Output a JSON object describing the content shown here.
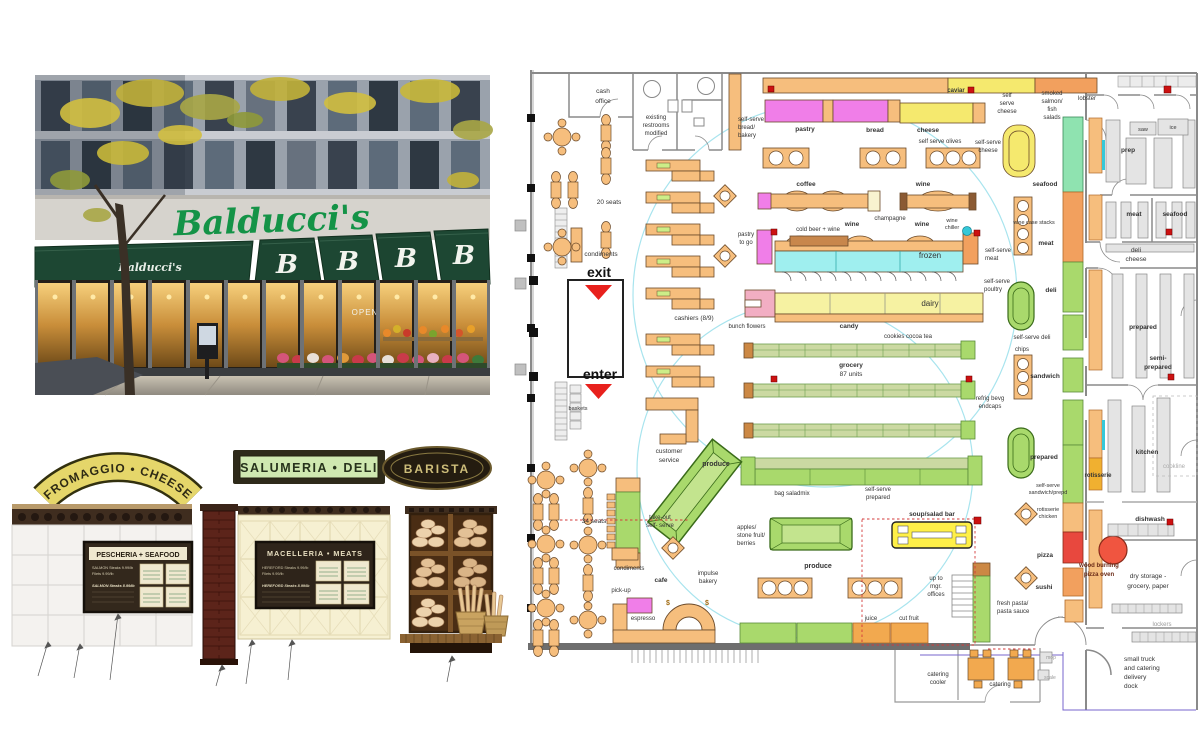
{
  "photo": {
    "script_sign": "Balducci's",
    "awning_script": "Balducci's",
    "awning_monogram": "B",
    "open_sign": "OPEN"
  },
  "signs": {
    "fromaggio": "FROMAGGIO • CHEESE",
    "salumeria": "SALUMERIA • DELI",
    "barista": "BARISTA"
  },
  "elevations": {
    "pescheria_title": "PESCHERIA + SEAFOOD",
    "pescheria_lines": [
      "SALMON Steaks   9.99/lb",
      "Filets   9.99/lb",
      "SALMON  Steaks   8.99/lb"
    ],
    "macelleria_title": "MACELLERIA • MEATS",
    "macelleria_lines": [
      "HEREFORD Steaks   9.99/lb",
      "Filets   9.99/lb",
      "HEREFORD  Steaks   8.99/lb"
    ]
  },
  "plan": {
    "labels": [
      {
        "t": "cash",
        "x": 603,
        "y": 93,
        "s": 6.5
      },
      {
        "t": "office",
        "x": 603,
        "y": 103,
        "s": 6.5
      },
      {
        "t": "existing",
        "x": 656,
        "y": 119,
        "s": 6
      },
      {
        "t": "restrooms",
        "x": 656,
        "y": 127,
        "s": 6
      },
      {
        "t": "modified",
        "x": 656,
        "y": 135,
        "s": 6
      },
      {
        "t": "20 seats",
        "x": 609,
        "y": 204,
        "s": 6.5
      },
      {
        "t": "condiments",
        "x": 601,
        "y": 256,
        "s": 6.5
      },
      {
        "t": "exit",
        "x": 599,
        "y": 277,
        "s": 14,
        "b": 1,
        "c": "#111"
      },
      {
        "t": "enter",
        "x": 600,
        "y": 379,
        "s": 14,
        "b": 1,
        "c": "#111"
      },
      {
        "t": "baskets",
        "x": 578,
        "y": 410,
        "s": 5.5
      },
      {
        "t": "cashiers (8/9)",
        "x": 694,
        "y": 320,
        "s": 6.5
      },
      {
        "t": "customer",
        "x": 669,
        "y": 453,
        "s": 6.5
      },
      {
        "t": "service",
        "x": 669,
        "y": 462,
        "s": 6.5
      },
      {
        "t": "self-serve",
        "x": 738,
        "y": 121,
        "s": 6,
        "a": "s"
      },
      {
        "t": "bread/",
        "x": 738,
        "y": 129,
        "s": 6,
        "a": "s"
      },
      {
        "t": "bakery",
        "x": 738,
        "y": 137,
        "s": 6,
        "a": "s"
      },
      {
        "t": "pastry",
        "x": 805,
        "y": 131,
        "s": 6.5,
        "b": 1
      },
      {
        "t": "bread",
        "x": 875,
        "y": 132,
        "s": 6.5,
        "b": 1
      },
      {
        "t": "cheese",
        "x": 928,
        "y": 132,
        "s": 6.5,
        "b": 1
      },
      {
        "t": "self serve olives",
        "x": 940,
        "y": 143,
        "s": 6
      },
      {
        "t": "caviar",
        "x": 956,
        "y": 92,
        "s": 6,
        "b": 1
      },
      {
        "t": "self",
        "x": 1007,
        "y": 97,
        "s": 6
      },
      {
        "t": "serve",
        "x": 1007,
        "y": 105,
        "s": 6
      },
      {
        "t": "cheese",
        "x": 1007,
        "y": 113,
        "s": 6
      },
      {
        "t": "smoked",
        "x": 1052,
        "y": 95,
        "s": 6
      },
      {
        "t": "salmon/",
        "x": 1052,
        "y": 103,
        "s": 6
      },
      {
        "t": "fish",
        "x": 1052,
        "y": 111,
        "s": 6
      },
      {
        "t": "salads",
        "x": 1052,
        "y": 119,
        "s": 6
      },
      {
        "t": "lobster",
        "x": 1087,
        "y": 100,
        "s": 6
      },
      {
        "t": "self-serve",
        "x": 988,
        "y": 144,
        "s": 6
      },
      {
        "t": "cheese",
        "x": 988,
        "y": 152,
        "s": 6
      },
      {
        "t": "coffee",
        "x": 806,
        "y": 186,
        "s": 6.5,
        "b": 1
      },
      {
        "t": "wine",
        "x": 923,
        "y": 186,
        "s": 6.5,
        "b": 1
      },
      {
        "t": "champagne",
        "x": 890,
        "y": 220,
        "s": 6
      },
      {
        "t": "wine",
        "x": 852,
        "y": 226,
        "s": 6.5,
        "b": 1
      },
      {
        "t": "wine",
        "x": 922,
        "y": 226,
        "s": 6.5,
        "b": 1
      },
      {
        "t": "wine",
        "x": 952,
        "y": 222,
        "s": 5.5
      },
      {
        "t": "chiller",
        "x": 952,
        "y": 229,
        "s": 5.5
      },
      {
        "t": "cold beer + wine",
        "x": 818,
        "y": 231,
        "s": 6
      },
      {
        "t": "pastry",
        "x": 746,
        "y": 236,
        "s": 6
      },
      {
        "t": "to go",
        "x": 746,
        "y": 244,
        "s": 6
      },
      {
        "t": "frozen",
        "x": 930,
        "y": 258,
        "s": 8
      },
      {
        "t": "self-serve",
        "x": 985,
        "y": 252,
        "s": 6,
        "a": "s"
      },
      {
        "t": "meat",
        "x": 985,
        "y": 260,
        "s": 6,
        "a": "s"
      },
      {
        "t": "self-serve",
        "x": 984,
        "y": 283,
        "s": 6,
        "a": "s"
      },
      {
        "t": "poultry",
        "x": 984,
        "y": 291,
        "s": 6,
        "a": "s"
      },
      {
        "t": "dairy",
        "x": 930,
        "y": 306,
        "s": 8
      },
      {
        "t": "bunch flowers",
        "x": 747,
        "y": 328,
        "s": 6
      },
      {
        "t": "candy",
        "x": 849,
        "y": 328,
        "s": 6.5,
        "b": 1
      },
      {
        "t": "cookies cocoa tea",
        "x": 908,
        "y": 338,
        "s": 6
      },
      {
        "t": "grocery",
        "x": 851,
        "y": 367,
        "s": 6.5,
        "b": 1
      },
      {
        "t": "87 units",
        "x": 851,
        "y": 376,
        "s": 6.5
      },
      {
        "t": "refrig bevg",
        "x": 990,
        "y": 400,
        "s": 6
      },
      {
        "t": "endcaps",
        "x": 990,
        "y": 408,
        "s": 6
      },
      {
        "t": "seafood",
        "x": 1045,
        "y": 186,
        "s": 6.5,
        "b": 1
      },
      {
        "t": "meat",
        "x": 1046,
        "y": 245,
        "s": 6.5,
        "b": 1
      },
      {
        "t": "wine case stacks",
        "x": 1034,
        "y": 224,
        "s": 5.5
      },
      {
        "t": "chips",
        "x": 1022,
        "y": 351,
        "s": 6
      },
      {
        "t": "deli",
        "x": 1051,
        "y": 292,
        "s": 6.5,
        "b": 1
      },
      {
        "t": "self-serve deli",
        "x": 1032,
        "y": 339,
        "s": 6
      },
      {
        "t": "sandwich",
        "x": 1045,
        "y": 378,
        "s": 6.5,
        "b": 1
      },
      {
        "t": "prepared",
        "x": 1044,
        "y": 459,
        "s": 6.5,
        "b": 1
      },
      {
        "t": "self-serve",
        "x": 1048,
        "y": 487,
        "s": 5.5
      },
      {
        "t": "sandwich/prepd",
        "x": 1048,
        "y": 494,
        "s": 5.5
      },
      {
        "t": "rotisserie",
        "x": 1048,
        "y": 511,
        "s": 5.5
      },
      {
        "t": "chicken",
        "x": 1048,
        "y": 518,
        "s": 5.5
      },
      {
        "t": "pizza",
        "x": 1045,
        "y": 557,
        "s": 6.5,
        "b": 1
      },
      {
        "t": "sushi",
        "x": 1044,
        "y": 589,
        "s": 6.5,
        "b": 1
      },
      {
        "t": "rotisserie",
        "x": 1098,
        "y": 477,
        "s": 6,
        "b": 1
      },
      {
        "t": "wood burning",
        "x": 1099,
        "y": 567,
        "s": 6,
        "b": 1,
        "c": "#6b2b18"
      },
      {
        "t": "pizza oven",
        "x": 1099,
        "y": 576,
        "s": 6,
        "b": 1,
        "c": "#6b2b18"
      },
      {
        "t": "dishwash",
        "x": 1150,
        "y": 521,
        "s": 6.5,
        "b": 1
      },
      {
        "t": "dry storage -",
        "x": 1148,
        "y": 578,
        "s": 6.5
      },
      {
        "t": "grocery, paper",
        "x": 1148,
        "y": 588,
        "s": 6.5
      },
      {
        "t": "lockers",
        "x": 1162,
        "y": 626,
        "s": 6,
        "c": "#999"
      },
      {
        "t": "small truck",
        "x": 1124,
        "y": 661,
        "s": 6.5,
        "a": "s"
      },
      {
        "t": "and catering",
        "x": 1124,
        "y": 670,
        "s": 6.5,
        "a": "s"
      },
      {
        "t": "delivery",
        "x": 1124,
        "y": 679,
        "s": 6.5,
        "a": "s"
      },
      {
        "t": "dock",
        "x": 1124,
        "y": 688,
        "s": 6.5,
        "a": "s"
      },
      {
        "t": "kitchen",
        "x": 1147,
        "y": 454,
        "s": 6.5,
        "b": 1
      },
      {
        "t": "cookline",
        "x": 1174,
        "y": 468,
        "s": 6,
        "c": "#aaa"
      },
      {
        "t": "prep",
        "x": 1128,
        "y": 152,
        "s": 6.5,
        "b": 1
      },
      {
        "t": "saw",
        "x": 1143,
        "y": 131,
        "s": 5.5
      },
      {
        "t": "ice",
        "x": 1173,
        "y": 129,
        "s": 5.5
      },
      {
        "t": "meat",
        "x": 1134,
        "y": 216,
        "s": 6.5,
        "b": 1
      },
      {
        "t": "seafood",
        "x": 1175,
        "y": 216,
        "s": 6.5,
        "b": 1
      },
      {
        "t": "deli",
        "x": 1136,
        "y": 252,
        "s": 6.5
      },
      {
        "t": "cheese",
        "x": 1136,
        "y": 261,
        "s": 6.5
      },
      {
        "t": "prepared",
        "x": 1143,
        "y": 329,
        "s": 6.5,
        "b": 1
      },
      {
        "t": "semi-",
        "x": 1158,
        "y": 360,
        "s": 6.5,
        "b": 1
      },
      {
        "t": "prepared",
        "x": 1158,
        "y": 369,
        "s": 6.5,
        "b": 1
      },
      {
        "t": "produce",
        "x": 716,
        "y": 466,
        "s": 7,
        "b": 1
      },
      {
        "t": "take-out",
        "x": 660,
        "y": 519,
        "s": 6
      },
      {
        "t": "self- serve",
        "x": 660,
        "y": 527,
        "s": 6
      },
      {
        "t": "apples/",
        "x": 737,
        "y": 529,
        "s": 6,
        "a": "s"
      },
      {
        "t": "stone fruit/",
        "x": 737,
        "y": 537,
        "s": 6,
        "a": "s"
      },
      {
        "t": "berries",
        "x": 737,
        "y": 545,
        "s": 6,
        "a": "s"
      },
      {
        "t": "bag saladmix",
        "x": 792,
        "y": 495,
        "s": 6
      },
      {
        "t": "self-serve",
        "x": 878,
        "y": 491,
        "s": 6
      },
      {
        "t": "prepared",
        "x": 878,
        "y": 499,
        "s": 6
      },
      {
        "t": "produce",
        "x": 818,
        "y": 568,
        "s": 7,
        "b": 1
      },
      {
        "t": "34 seats",
        "x": 594,
        "y": 523,
        "s": 6.5
      },
      {
        "t": "condiments",
        "x": 629,
        "y": 570,
        "s": 6
      },
      {
        "t": "cafe",
        "x": 661,
        "y": 582,
        "s": 6.5,
        "b": 1
      },
      {
        "t": "pick-up",
        "x": 621,
        "y": 592,
        "s": 6
      },
      {
        "t": "espresso",
        "x": 643,
        "y": 620,
        "s": 6
      },
      {
        "t": "impulse",
        "x": 708,
        "y": 575,
        "s": 6
      },
      {
        "t": "bakery",
        "x": 708,
        "y": 583,
        "s": 6
      },
      {
        "t": "soup/salad bar",
        "x": 932,
        "y": 516,
        "s": 6.5,
        "b": 1
      },
      {
        "t": "up to",
        "x": 936,
        "y": 580,
        "s": 6
      },
      {
        "t": "mgr.",
        "x": 936,
        "y": 588,
        "s": 6
      },
      {
        "t": "offices",
        "x": 936,
        "y": 596,
        "s": 6
      },
      {
        "t": "fresh pasta/",
        "x": 997,
        "y": 605,
        "s": 6,
        "a": "s"
      },
      {
        "t": "pasta sauce",
        "x": 997,
        "y": 613,
        "s": 6,
        "a": "s"
      },
      {
        "t": "juice",
        "x": 871,
        "y": 620,
        "s": 6
      },
      {
        "t": "cut fruit",
        "x": 909,
        "y": 620,
        "s": 6
      },
      {
        "t": "mop",
        "x": 1051,
        "y": 659,
        "s": 5,
        "c": "#999"
      },
      {
        "t": "scale",
        "x": 1050,
        "y": 679,
        "s": 5,
        "c": "#999"
      },
      {
        "t": "catering",
        "x": 938,
        "y": 676,
        "s": 6
      },
      {
        "t": "cooler",
        "x": 938,
        "y": 684,
        "s": 6
      },
      {
        "t": "catering",
        "x": 1000,
        "y": 686,
        "s": 6
      },
      {
        "t": "$",
        "x": 668,
        "y": 605,
        "s": 7,
        "b": 1,
        "c": "#a06a10"
      },
      {
        "t": "$",
        "x": 707,
        "y": 605,
        "s": 7,
        "b": 1,
        "c": "#a06a10"
      }
    ]
  }
}
